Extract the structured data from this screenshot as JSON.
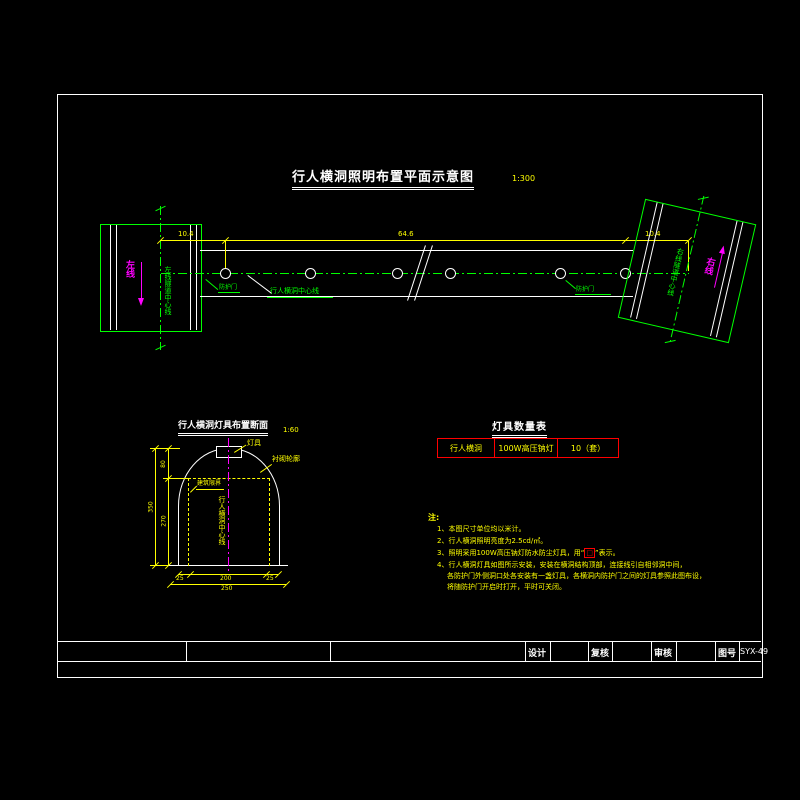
{
  "colors": {
    "green": "#00ff00",
    "yellow": "#ffff00",
    "magenta": "#ff00ff",
    "white": "#ffffff",
    "red": "#ff0000"
  },
  "plan": {
    "title": "行人横洞照明布置平面示意图",
    "scale": "1:300",
    "dim_left": "10.4",
    "dim_mid": "64.6",
    "dim_right": "10.4",
    "corridor_label": "行人横洞中心线",
    "door_left": "防护门",
    "door_right": "防护门",
    "left_centerline_label": "左线隧道中心线",
    "right_centerline_label": "右线隧道中心线",
    "left_direction": "左线",
    "right_direction": "右线"
  },
  "section": {
    "title": "行人横洞灯具布置断面",
    "scale": "1:60",
    "lamp_label": "灯具",
    "lining_label": "衬砌轮廓",
    "clearance_label": "建筑限界",
    "centerline_label": "行人横洞中心线",
    "dims": {
      "left_upper": "80",
      "left_lower": "270",
      "left_total": "350",
      "bottom_left": "25",
      "bottom_mid": "200",
      "bottom_right": "25",
      "bottom_total": "250"
    }
  },
  "table": {
    "title": "灯具数量表",
    "row": [
      "行人横洞",
      "100W高压钠灯",
      "10（套）"
    ]
  },
  "notes": {
    "heading": "注:",
    "line1": "1、本图尺寸单位均以米计。",
    "line2": "2、行人横洞照明亮度为2.5cd/㎡。",
    "line3_pre": "3、照明采用100W高压钠灯防水防尘灯具，用“",
    "line3_symbol": "□",
    "line3_post": "”表示。",
    "line4a": "4、行人横洞灯具如图所示安装，安装在横洞结构顶部，连接线引自相邻洞中间，",
    "line4b": "各防护门外侧洞口处各安装有一盏灯具，各横洞内防护门之间的灯具参照此图布设，",
    "line4c": "将随防护门开启时打开，平时可关闭。"
  },
  "titleblock": {
    "design": "设计",
    "check": "复核",
    "review": "审核",
    "dwg_no_label": "图号",
    "dwg_no": "SYX-49"
  }
}
